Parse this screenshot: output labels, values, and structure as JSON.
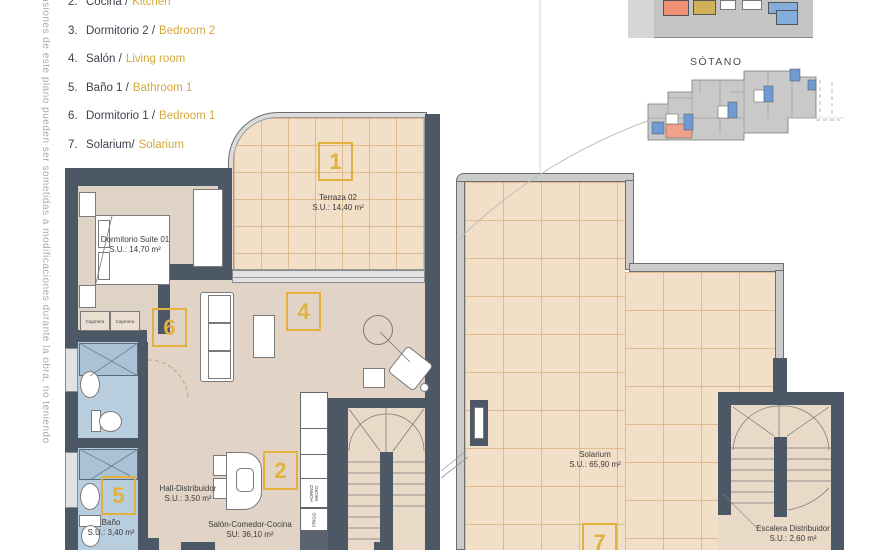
{
  "disclaimer": "ensiones de este plano pueden ser sometidas a modificaciones durante la obra, no teniendo",
  "legend": {
    "items": [
      {
        "num": "2.",
        "es": "Cocina /",
        "en": "Kitchen"
      },
      {
        "num": "3.",
        "es": "Dormitorio 2 /",
        "en": "Bedroom 2"
      },
      {
        "num": "4.",
        "es": "Salón /",
        "en": "Living room"
      },
      {
        "num": "5.",
        "es": "Baño 1 /",
        "en": "Bathroom 1"
      },
      {
        "num": "6.",
        "es": "Dormitorio 1 /",
        "en": "Bedroom 1"
      },
      {
        "num": "7.",
        "es": "Solarium/",
        "en": "Solarium"
      }
    ]
  },
  "overview": {
    "sotano_label": "SÓTANO"
  },
  "plan": {
    "terraza": {
      "name": "Terraza 02",
      "area": "S.U.: 14,40 m²",
      "tag": "1"
    },
    "dormitorio": {
      "name": "Dormitorio Suite 01",
      "area": "S.U.: 14,70 m²",
      "tag": "6",
      "cajonera_left": "Cajonera",
      "cajonera_right": "Cajonera"
    },
    "bano": {
      "name": "Baño",
      "area": "S.U.: 3,40 m²",
      "tag": "5"
    },
    "hall": {
      "name": "Hall-Distribuidor",
      "area": "S.U.: 3,50 m²"
    },
    "salon": {
      "name": "Salón-Comedor-Cocina",
      "area": "SU: 36,10 m²",
      "tag_salon": "4",
      "tag_cocina": "2"
    },
    "solarium": {
      "name": "Solarium",
      "area": "S.U.: 65,90 m²",
      "tag": "7"
    },
    "escalera": {
      "name": "Escalera Distribuidor",
      "area": "S.U.: 2,60 m²"
    },
    "kitchen_appliances": {
      "oven": "HORNO",
      "micro": "MICRO",
      "fridge": "FRIGO"
    }
  },
  "colors": {
    "accent_gold": "#E3B13E",
    "wall_dark": "#4D5866",
    "tile_fill": "#F2DFC8",
    "tile_line": "#D9A878",
    "bath_blue": "#B8CDDE",
    "floor_beige": "#E1D4C6",
    "overview_salmon": "#EF9077",
    "overview_tan": "#D2B05A",
    "overview_blue": "#84AEDE",
    "plan_gray": "#C9C9C9"
  }
}
